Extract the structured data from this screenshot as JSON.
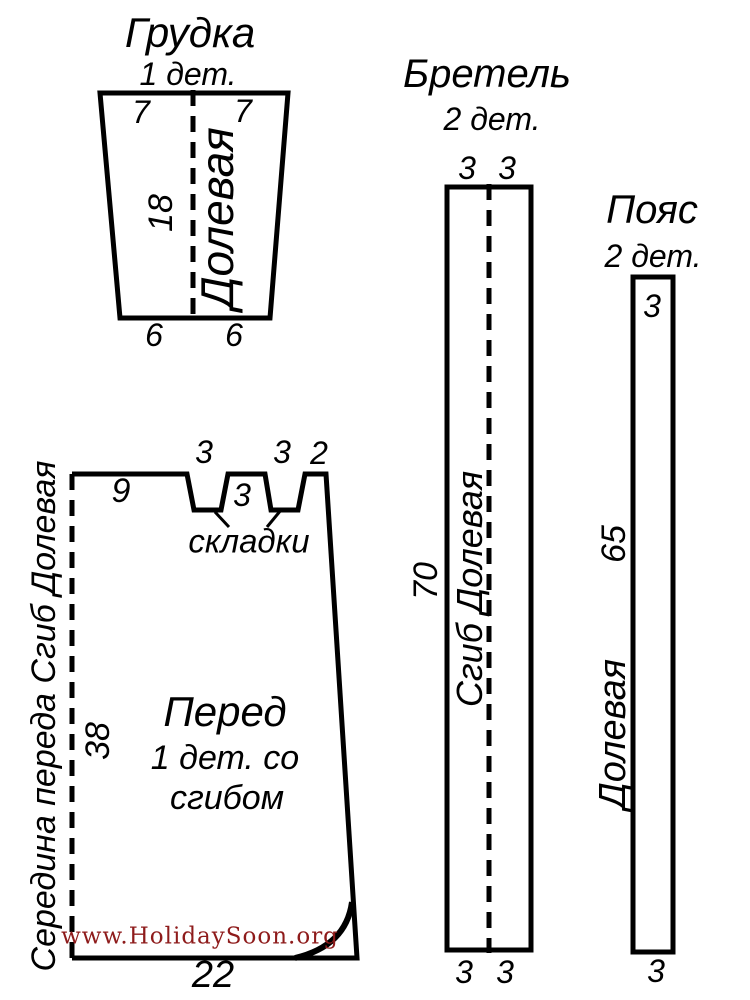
{
  "pieces": {
    "grudka": {
      "title": "Грудка",
      "count": "1 дет.",
      "width_top_left": "7",
      "width_top_right": "7",
      "height": "18",
      "grainline_label": "Долевая",
      "width_bottom_left": "6",
      "width_bottom_right": "6"
    },
    "bretel": {
      "title": "Бретель",
      "count": "2 дет.",
      "width_top_left": "3",
      "width_top_right": "3",
      "length": "70",
      "grainline_label": "Сгиб Долевая",
      "width_bottom_left": "3",
      "width_bottom_right": "3"
    },
    "poyas": {
      "title": "Пояс",
      "count": "2 дет.",
      "width_top": "3",
      "length": "65",
      "grainline_label": "Долевая",
      "width_bottom": "3"
    },
    "pered": {
      "title": "Перед",
      "count_line1": "1 дет. со",
      "count_line2": "сгибом",
      "top_segment": "9",
      "pleat1_width": "3",
      "between_pleats": "3",
      "pleat2_width": "3",
      "corner_segment": "2",
      "pleats_label": "складки",
      "side_length": "38",
      "fold_label": "Середина переда Сгиб Долевая",
      "bottom_width": "22"
    }
  },
  "watermark": {
    "text": "www.HolidaySoon.org",
    "color": "#8e1b1b"
  },
  "colors": {
    "line": "#000000",
    "background": "#ffffff"
  }
}
